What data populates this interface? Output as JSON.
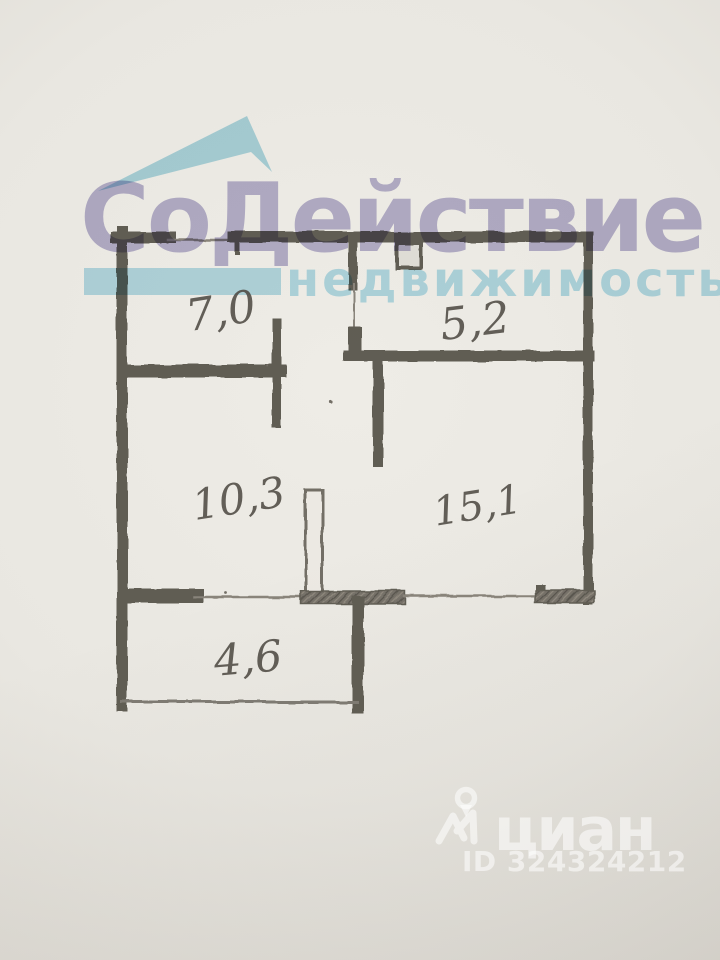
{
  "logo": {
    "title": "СоДействие",
    "subtitle": "недвижимость",
    "title_color": "#a9a4cc",
    "subtitle_color": "#a9d9e9",
    "roof_color": "#a5d6e6"
  },
  "rooms": [
    {
      "name": "room-top-left",
      "label": "7,0",
      "area_m2": 7.0
    },
    {
      "name": "room-top-right",
      "label": "5,2",
      "area_m2": 5.2
    },
    {
      "name": "room-center",
      "label": "10,3",
      "area_m2": 10.3
    },
    {
      "name": "room-right",
      "label": "15,1",
      "area_m2": 15.1
    },
    {
      "name": "room-bottom-left",
      "label": "4,6",
      "area_m2": 4.6
    }
  ],
  "cian": {
    "name": "циан",
    "listing_id": "ID 324324212",
    "icon": "person-with-location-pin-icon",
    "watermark_color": "rgba(255,255,255,0.55)"
  },
  "colors": {
    "paper": "#eae8e2",
    "paper_edge": "#d5d2cb",
    "pencil": "#57534a",
    "pencil_light": "#827d73"
  }
}
